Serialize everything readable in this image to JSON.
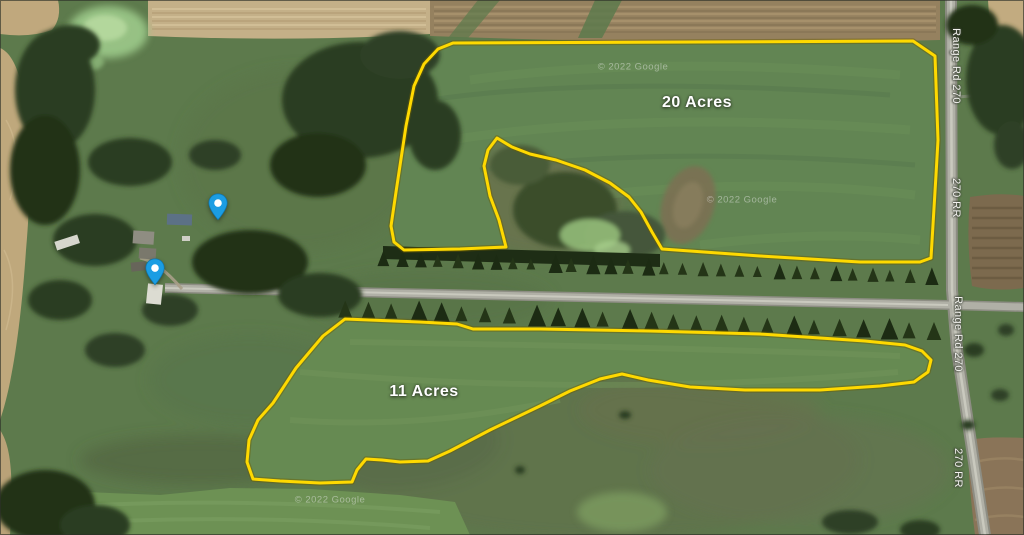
{
  "map": {
    "accent_color": "#FFD900",
    "marker_color": "#1B9DE3",
    "parcels": [
      {
        "label": "20 Acres"
      },
      {
        "label": "11 Acres"
      }
    ],
    "road_labels": [
      "Range Rd 270",
      "270 RR",
      "Range Rd 270",
      "270 RR"
    ],
    "watermarks": [
      "© 2022 Google",
      "© 2022 Google",
      "© 2022 Google"
    ],
    "markers": [
      {
        "name": "blue-map-pin-north"
      },
      {
        "name": "blue-map-pin-south"
      }
    ]
  }
}
